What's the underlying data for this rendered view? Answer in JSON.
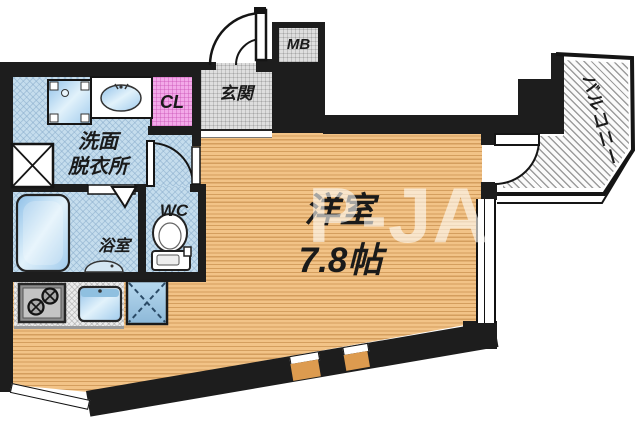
{
  "plan": {
    "labels": {
      "main_room": "洋室",
      "main_room_size": "7.8帖",
      "entrance": "玄関",
      "closet": "CL",
      "meter_box": "MB",
      "washroom_line1": "洗面",
      "washroom_line2": "脱衣所",
      "toilet": "WC",
      "bathroom": "浴室",
      "balcony": "バルコニー"
    },
    "watermark": "P-JA",
    "colors": {
      "wall": "#1d1d1d",
      "wood_floor": "#f2c387",
      "wood_stripe": "#d49e5e",
      "wet_floor": "#c5dded",
      "tile_floor": "#dedede",
      "closet_floor": "#f3a9e9",
      "fixture_blue": "#a9cfe8",
      "balcony_hatch": "#9c9c9c",
      "accent_window": "#dd9b4f"
    }
  }
}
